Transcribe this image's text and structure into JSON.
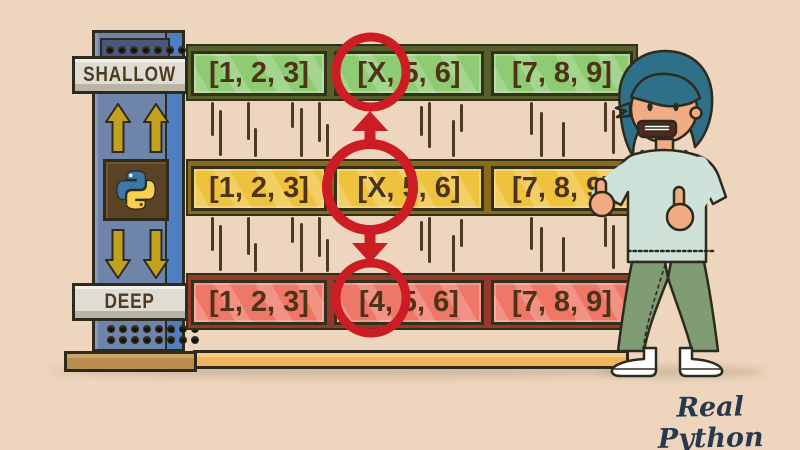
{
  "title": "Shallow vs Deep Copy illustration",
  "background_color": "#eed6be",
  "tower": {
    "shallow_label": "SHALLOW",
    "deep_label": "DEEP",
    "body_color": "#6e84a8",
    "accent_strip_color": "#4e7fc3",
    "sign_color": "#dfddd3",
    "sign_text_color": "#4f3b22",
    "arrow_color": "#c2a11f",
    "python_box_color": "#5a4325",
    "python_logo_blue": "#3c77a8",
    "python_logo_yellow": "#f7d14d"
  },
  "shelves": {
    "text_color": "#4f3317",
    "rows": [
      {
        "name": "shallow-copy-list",
        "fill": "#8ecb72",
        "edge": "#57602c",
        "cells": [
          "[1, 2, 3]",
          "[X, 5, 6]",
          "[7, 8, 9]"
        ]
      },
      {
        "name": "original-list",
        "fill": "#efc23e",
        "edge": "#8a6b1a",
        "cells": [
          "[1, 2, 3]",
          "[X, 5, 6]",
          "[7, 8, 9]"
        ]
      },
      {
        "name": "deep-copy-list",
        "fill": "#ee7767",
        "edge": "#93382b",
        "cells": [
          "[1, 2, 3]",
          "[4, 5, 6]",
          "[7, 8, 9]"
        ]
      }
    ]
  },
  "annotations": {
    "highlight_color": "#cd1d24",
    "circled_values": [
      "X",
      "X",
      "4"
    ],
    "arrows": [
      "middle-to-top",
      "middle-to-bottom"
    ]
  },
  "base": {
    "left_plank_color": "#b98d4e",
    "right_plank_color": "#f3b45c"
  },
  "character": {
    "description": "man giving two thumbs up",
    "hair_color": "#2f7089",
    "skin_color": "#f2ac83",
    "sweater_color": "#cfe2da",
    "pants_color": "#7f9c74",
    "shoe_color": "#ffffff"
  },
  "branding": {
    "logo_text": "Real Python",
    "color": "#28394d"
  }
}
